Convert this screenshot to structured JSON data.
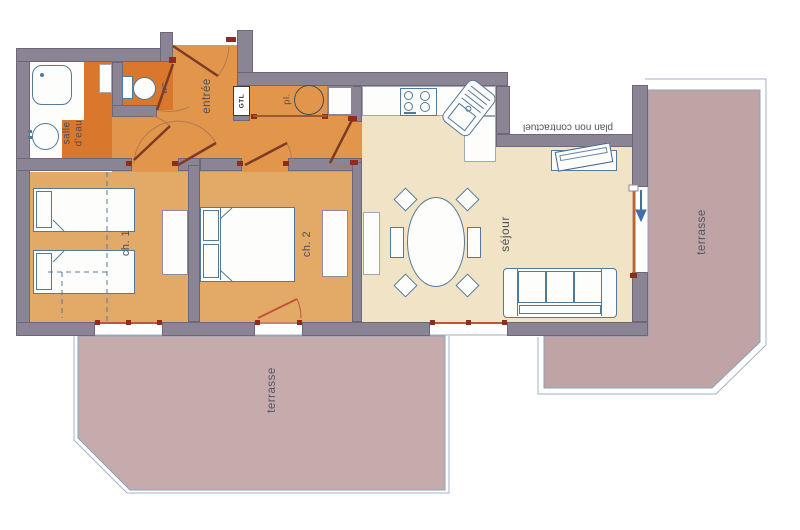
{
  "title": "Apartment floor plan",
  "labels": {
    "bathroom_line1": "salle",
    "bathroom_line2": "d'eau",
    "wc": "wc",
    "entry": "entrée",
    "gtl": "GTL",
    "closet": "pl.",
    "bedroom1": "ch. 1",
    "bedroom2": "ch. 2",
    "living_room": "séjour",
    "terrace_bottom": "terrasse",
    "terrace_right": "terrasse",
    "disclaimer": "plan non contractuel"
  },
  "colors": {
    "wall": "#8b8494",
    "hall_floor": "#e2964c",
    "wet_room_floor": "#d9772c",
    "bedroom_floor": "#e2a967",
    "living_floor": "#f1e4c6",
    "terrace_bottom_fill": "#c6abad",
    "terrace_right_fill": "#c0a3a5",
    "furniture_outline": "#527a99",
    "door_leaf": "#7e3b25",
    "window_frame": "#c0563a",
    "label_text": "#4f4f5a"
  }
}
